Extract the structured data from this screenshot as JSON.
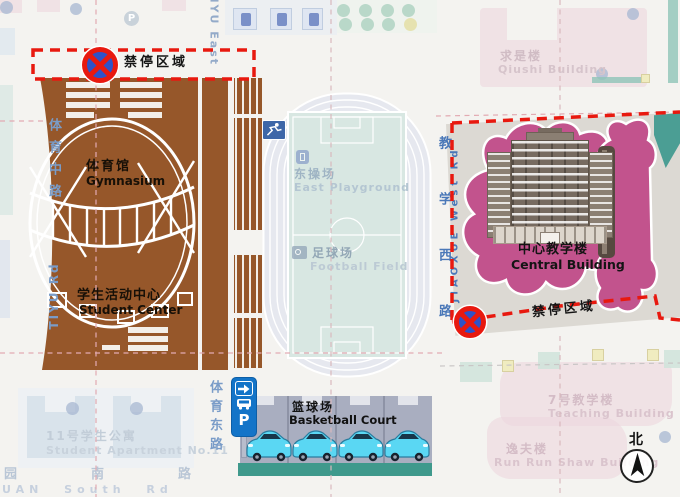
{
  "zones": {
    "no_parking": "禁停区域"
  },
  "buildings": {
    "gymnasium": {
      "zh": "体育馆",
      "en": "Gymnasium"
    },
    "student_center": {
      "zh": "学生活动中心",
      "en": "Student Center"
    },
    "east_playground": {
      "zh": "东操场",
      "en": "East Playground"
    },
    "football_field": {
      "zh": "足球场",
      "en": "Football Field"
    },
    "basketball_court": {
      "zh": "篮球场",
      "en": "Basketball Court"
    },
    "central_building": {
      "zh": "中心教学楼",
      "en": "Central Building"
    },
    "qiushi_building": {
      "zh": "求是楼",
      "en": "Qiushi Building"
    },
    "student_apartment_11": {
      "zh": "11号学生公寓",
      "en": "Student Apartment No.11"
    },
    "teaching_building_7": {
      "zh": "7号教学楼",
      "en": "Teaching Building No.7"
    },
    "run_run_shaw": {
      "zh": "逸夫楼",
      "en": "Run Run Shaw Building"
    }
  },
  "roads": {
    "tiyu_middle_zh": "体育中路",
    "tiyu_rd_en": "TIYU Rd",
    "tiyu_east_en": "TIYU East",
    "tiyu_east_zh": "体育东路",
    "jiaoxue_west_zh": "教学西路",
    "jiaoxue_west_en": "JIAOXUE West Rd",
    "south_rd_zh": "园南路",
    "south_rd_en": "UAN South Rd"
  },
  "markers": {
    "parking_label": "P",
    "north_label": "北"
  },
  "colors": {
    "building_brown": "#96572a",
    "magenta_blob": "#c2538d",
    "no_parking_red": "#e8190f",
    "parking_sign_blue": "#1374c8",
    "car_cyan": "#5ad7f3",
    "teal_strip": "#3f998c",
    "faded_pink": "#eed7de",
    "road_text_blue": "#7a9cc8",
    "track_fill": "#e6e8ef",
    "field_fill": "#d8e7e2",
    "plaza_grey": "#dcd9d3"
  }
}
